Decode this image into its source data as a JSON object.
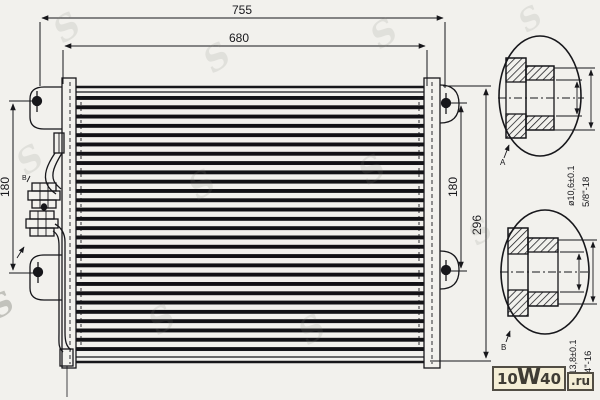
{
  "dimensions": {
    "overall_width": "755",
    "core_width": "680",
    "left_bracket_span": "180",
    "right_bracket_span": "180",
    "overall_height": "296"
  },
  "details": {
    "a": {
      "label": "A",
      "diameter": "ø10,6±0.1",
      "thread": "5/8\"-18"
    },
    "b": {
      "label": "B",
      "diameter": "ø13,8±0.1",
      "thread": "3/4\"-16"
    }
  },
  "ports": {
    "upper_label": "B"
  },
  "watermark": {
    "part1": "10",
    "part2": "W",
    "part3": "40",
    "domain": ".ru"
  }
}
